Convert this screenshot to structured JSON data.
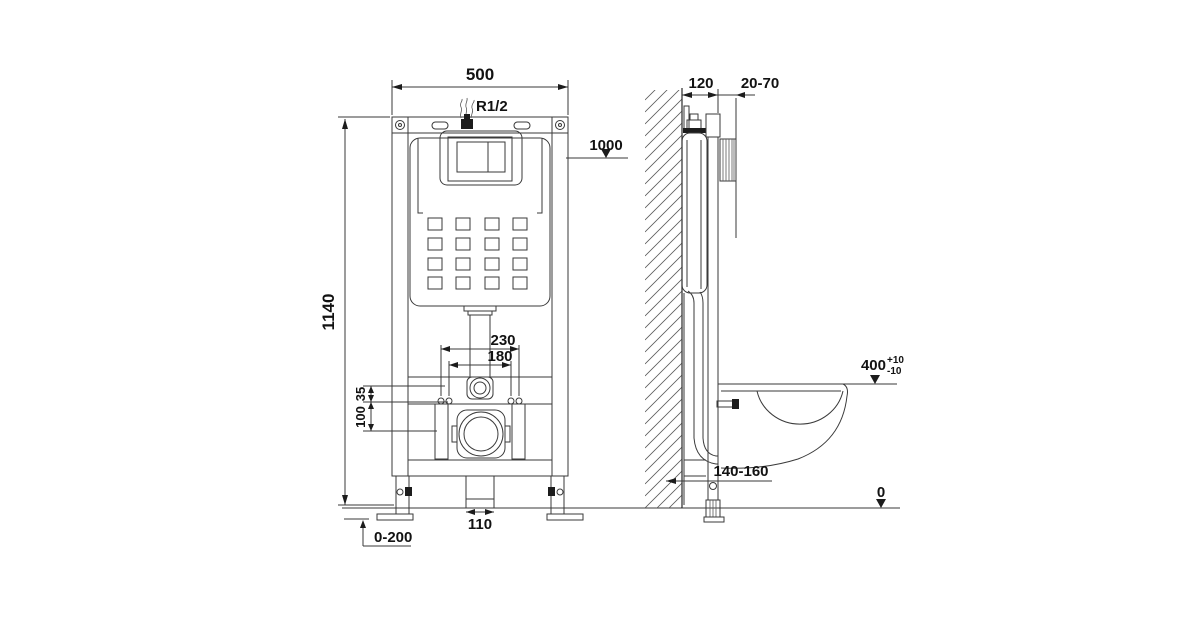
{
  "front_view": {
    "frame_width": "500",
    "water_supply_thread": "R1/2",
    "flush_pipe_level": "1000",
    "frame_height": "1140",
    "fixing_bolt_spacing_outer": "230",
    "fixing_bolt_spacing_inner": "180",
    "flange_to_bolts_offset": "35",
    "bolts_to_outlet_offset": "100",
    "outlet_pipe_width": "110",
    "feet_adjustment_range": "0-200"
  },
  "side_view": {
    "frame_depth": "120",
    "wall_finish_range": "20-70",
    "bowl_rim_height": "400",
    "bowl_rim_tolerance_plus": "+10",
    "bowl_rim_tolerance_minus": "-10",
    "waste_outlet_height_range": "140-160",
    "floor_level": "0"
  },
  "colors": {
    "line": "#3a3a3a",
    "text": "#121212",
    "background": "#ffffff"
  }
}
